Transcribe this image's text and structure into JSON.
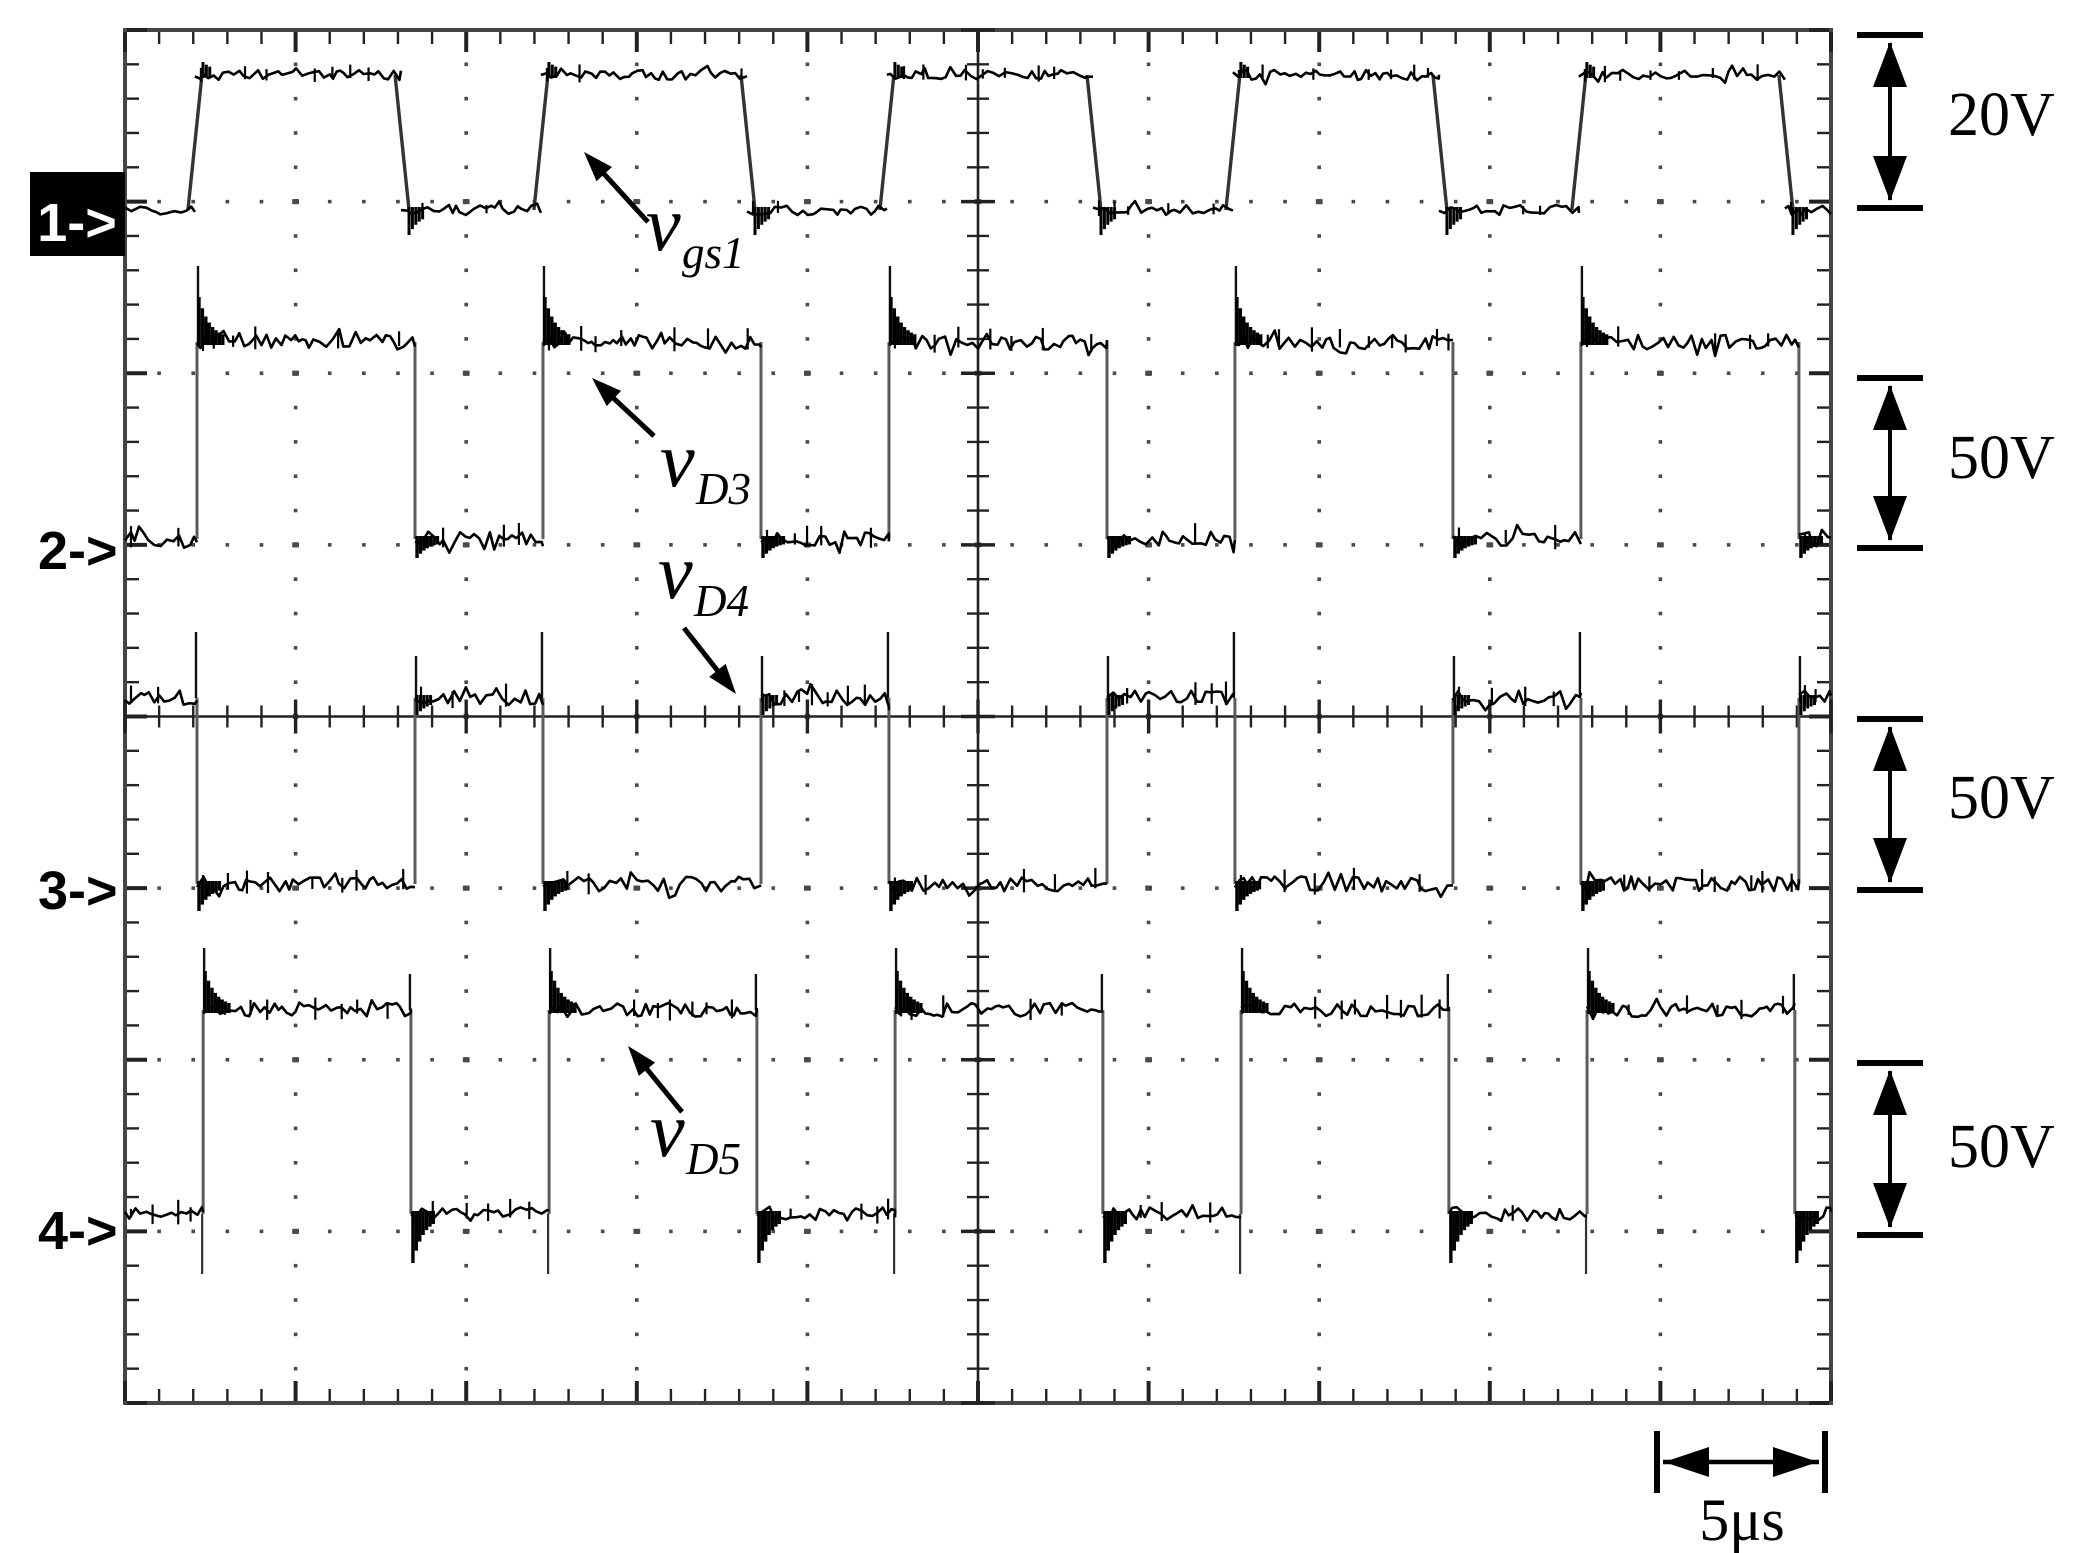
{
  "figure": {
    "bg": "#ffffff",
    "trace_color": "#000000",
    "edge_line_color": "#5b5b5b",
    "grid_dot_color": "#4a4a4a",
    "border_color": "#454545",
    "tick_color": "#222222",
    "marker1_box_color": "#000000",
    "marker1_text_color": "#ffffff"
  },
  "channel_markers": [
    {
      "label": "1->",
      "style": "inverse"
    },
    {
      "label": "2->",
      "style": "plain"
    },
    {
      "label": "3->",
      "style": "plain"
    },
    {
      "label": "4->",
      "style": "plain"
    }
  ],
  "trace_labels": [
    {
      "main": "v",
      "sub": "gs1"
    },
    {
      "main": "v",
      "sub": "D3"
    },
    {
      "main": "v",
      "sub": "D4"
    },
    {
      "main": "v",
      "sub": "D5"
    }
  ],
  "scale_annotations": {
    "vertical": [
      {
        "label": "20V"
      },
      {
        "label": "50V"
      },
      {
        "label": "50V"
      },
      {
        "label": "50V"
      }
    ],
    "horizontal": {
      "label": "5μs"
    }
  },
  "chart_data": {
    "type": "line",
    "subtype": "oscilloscope-square-waves",
    "title": "",
    "xlabel": "",
    "ylabel": "",
    "time_per_div_us": 5,
    "h_divisions": 10,
    "v_divisions": 8,
    "minor_per_div": 5,
    "total_time_us": 50,
    "grid": "dotted-graticule",
    "series": [
      {
        "name": "v_gs1",
        "channel": 1,
        "swing_label": "20V",
        "period_us": 10.14,
        "duty_pct": 60,
        "initial_state": "low",
        "rise_us": [
          2.05,
          12.19,
          22.33,
          32.47,
          42.61
        ],
        "fall_us": [
          8.09,
          18.23,
          28.37,
          38.51,
          48.65
        ]
      },
      {
        "name": "v_D3",
        "channel": 2,
        "swing_label": "50V",
        "period_us": 10.14,
        "duty_pct": 63,
        "initial_state": "low",
        "rise_us": [
          2.11,
          12.25,
          22.39,
          32.53,
          42.67
        ],
        "fall_us": [
          8.5,
          18.64,
          28.78,
          38.92,
          49.06
        ]
      },
      {
        "name": "v_D4",
        "channel": 3,
        "swing_label": "50V",
        "period_us": 10.14,
        "duty_pct": 37,
        "initial_state": "high",
        "rise_us": [
          8.5,
          18.64,
          28.78,
          38.92,
          49.06
        ],
        "fall_us": [
          2.11,
          12.25,
          22.39,
          32.53,
          42.67
        ]
      },
      {
        "name": "v_D5",
        "channel": 4,
        "swing_label": "50V",
        "period_us": 10.14,
        "duty_pct": 60,
        "initial_state": "low",
        "rise_us": [
          2.29,
          12.43,
          22.57,
          32.71,
          42.85
        ],
        "fall_us": [
          8.38,
          18.52,
          28.66,
          38.8,
          48.94
        ]
      }
    ]
  },
  "layout_px": {
    "canvas": {
      "w": 2081,
      "h": 1553
    },
    "plot": {
      "left": 125,
      "top": 30,
      "right": 1831,
      "bottom": 1403
    },
    "center": {
      "x": 978,
      "y": 716.5
    },
    "traces": [
      {
        "high_y": 75,
        "low_y": 210,
        "noise": 5,
        "slant": 7,
        "rise_over_small": 10,
        "fall_under": 22
      },
      {
        "high_y": 342,
        "low_y": 539,
        "noise": 7.5,
        "rise_spike": 76,
        "rise_blob": 42,
        "fall_under": 16
      },
      {
        "high_y": 698,
        "low_y": 884,
        "noise": 7.5,
        "rise_spike": 42,
        "rise_under_blob": 14,
        "pre_fall_spike": 66,
        "fall_under": 24
      },
      {
        "high_y": 1010,
        "low_y": 1214,
        "noise": 7,
        "rise_spike": 62,
        "rise_blob": 36,
        "rise_under": 60,
        "pre_fall_spike": 36,
        "fall_under": 46
      }
    ],
    "channel_marker_pos": [
      {
        "box": {
          "x": 30,
          "y": 172,
          "w": 95,
          "h": 84
        },
        "tx": 77,
        "ty": 241
      },
      {
        "tx": 38,
        "ty": 569
      },
      {
        "tx": 38,
        "ty": 909
      },
      {
        "tx": 38,
        "ty": 1249
      }
    ],
    "trace_label_pos": [
      {
        "mx": 646,
        "my": 250,
        "sx": 682,
        "sy": 268,
        "arrow": {
          "x1": 648,
          "y1": 222,
          "x2": 584,
          "y2": 152
        }
      },
      {
        "mx": 660,
        "my": 486,
        "sx": 696,
        "sy": 504,
        "arrow": {
          "x1": 654,
          "y1": 436,
          "x2": 592,
          "y2": 378
        }
      },
      {
        "mx": 658,
        "my": 598,
        "sx": 694,
        "sy": 616,
        "arrow": {
          "x1": 684,
          "y1": 628,
          "x2": 736,
          "y2": 694
        }
      },
      {
        "mx": 650,
        "my": 1156,
        "sx": 686,
        "sy": 1174,
        "arrow": {
          "x1": 682,
          "y1": 1112,
          "x2": 628,
          "y2": 1046
        }
      }
    ],
    "v_arrows": [
      {
        "x": 1890,
        "y1": 35,
        "y2": 208,
        "label_x": 1948,
        "label_y": 135
      },
      {
        "x": 1890,
        "y1": 378,
        "y2": 548,
        "label_x": 1948,
        "label_y": 478
      },
      {
        "x": 1890,
        "y1": 719,
        "y2": 890,
        "label_x": 1948,
        "label_y": 818
      },
      {
        "x": 1890,
        "y1": 1063,
        "y2": 1235,
        "label_x": 1948,
        "label_y": 1167
      }
    ],
    "h_scale": {
      "x1": 1657,
      "x2": 1825,
      "y": 1462,
      "bar_h": 62,
      "label_x": 1742,
      "label_y": 1540
    }
  }
}
